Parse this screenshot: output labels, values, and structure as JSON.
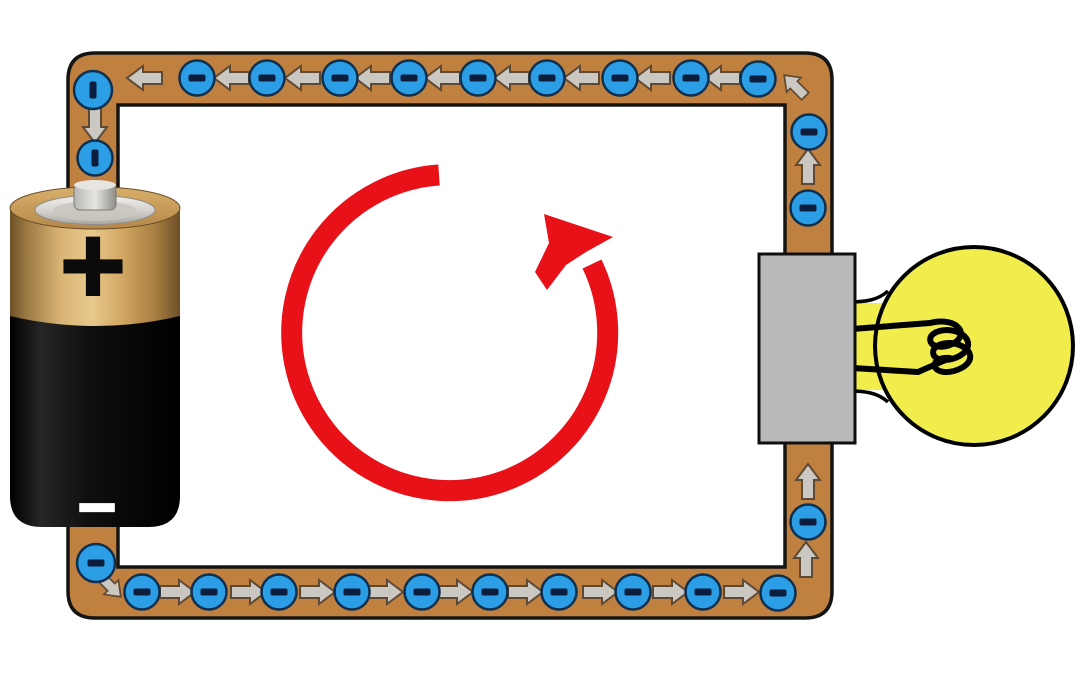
{
  "figure": {
    "type": "circuit-diagram",
    "background": "#ffffff"
  },
  "colors": {
    "wire": "#bf8040",
    "wire_outline": "#141414",
    "electron": "#2b9ee6",
    "electron_outline": "#0e3050",
    "electron_symbol_color": "#0c1d3d",
    "arrow": "#cbc8c1",
    "arrow_outline": "#5e4a34",
    "current_arrow": "#e81118",
    "bulb_glass": "#f0ed4d",
    "bulb_outline": "#000000",
    "bulb_base": "#b9b9b9",
    "battery_gold": "#c89b58",
    "battery_body": "#0a0a0a"
  },
  "battery": {
    "positive_label": "+",
    "negative_label": "−",
    "position": "left"
  },
  "bulb": {
    "position": "right",
    "filament": "coil"
  },
  "current_arrow": {
    "direction": "counterclockwise",
    "color": "#e81118"
  },
  "electron_symbol": "−",
  "particles": {
    "electrons": [
      {
        "x": 93,
        "y": 90,
        "dash": "v",
        "r": 19
      },
      {
        "x": 197,
        "y": 78,
        "dash": "h"
      },
      {
        "x": 267,
        "y": 78,
        "dash": "h"
      },
      {
        "x": 340,
        "y": 78,
        "dash": "h"
      },
      {
        "x": 409,
        "y": 78,
        "dash": "h"
      },
      {
        "x": 478,
        "y": 78,
        "dash": "h"
      },
      {
        "x": 547,
        "y": 78,
        "dash": "h"
      },
      {
        "x": 620,
        "y": 78,
        "dash": "h"
      },
      {
        "x": 691,
        "y": 78,
        "dash": "h"
      },
      {
        "x": 758,
        "y": 79,
        "dash": "h"
      },
      {
        "x": 809,
        "y": 132,
        "dash": "h"
      },
      {
        "x": 808,
        "y": 208,
        "dash": "h"
      },
      {
        "x": 808,
        "y": 522,
        "dash": "h"
      },
      {
        "x": 95,
        "y": 158,
        "dash": "v"
      },
      {
        "x": 96,
        "y": 563,
        "dash": "h",
        "r": 19
      },
      {
        "x": 142,
        "y": 592,
        "dash": "h"
      },
      {
        "x": 209,
        "y": 592,
        "dash": "h"
      },
      {
        "x": 279,
        "y": 592,
        "dash": "h"
      },
      {
        "x": 352,
        "y": 592,
        "dash": "h"
      },
      {
        "x": 422,
        "y": 592,
        "dash": "h"
      },
      {
        "x": 490,
        "y": 592,
        "dash": "h"
      },
      {
        "x": 559,
        "y": 592,
        "dash": "h"
      },
      {
        "x": 633,
        "y": 592,
        "dash": "h"
      },
      {
        "x": 703,
        "y": 592,
        "dash": "h"
      },
      {
        "x": 778,
        "y": 593,
        "dash": "h"
      }
    ],
    "arrows": [
      {
        "x": 145,
        "y": 78,
        "rot": 180
      },
      {
        "x": 232,
        "y": 78,
        "rot": 180
      },
      {
        "x": 303,
        "y": 78,
        "rot": 180
      },
      {
        "x": 373,
        "y": 78,
        "rot": 180
      },
      {
        "x": 443,
        "y": 78,
        "rot": 180
      },
      {
        "x": 512,
        "y": 78,
        "rot": 180
      },
      {
        "x": 582,
        "y": 78,
        "rot": 180
      },
      {
        "x": 653,
        "y": 78,
        "rot": 180
      },
      {
        "x": 723,
        "y": 78,
        "rot": 180
      },
      {
        "x": 795,
        "y": 86,
        "rot": -135,
        "s": 0.85
      },
      {
        "x": 808,
        "y": 167,
        "rot": -90
      },
      {
        "x": 808,
        "y": 482,
        "rot": -90
      },
      {
        "x": 806,
        "y": 560,
        "rot": -90
      },
      {
        "x": 95,
        "y": 125,
        "rot": 90
      },
      {
        "x": 110,
        "y": 586,
        "rot": 45,
        "s": 0.85
      },
      {
        "x": 177,
        "y": 592,
        "rot": 0
      },
      {
        "x": 248,
        "y": 592,
        "rot": 0
      },
      {
        "x": 317,
        "y": 592,
        "rot": 0
      },
      {
        "x": 385,
        "y": 592,
        "rot": 0
      },
      {
        "x": 455,
        "y": 592,
        "rot": 0
      },
      {
        "x": 525,
        "y": 592,
        "rot": 0
      },
      {
        "x": 600,
        "y": 592,
        "rot": 0
      },
      {
        "x": 670,
        "y": 592,
        "rot": 0
      },
      {
        "x": 741,
        "y": 592,
        "rot": 0
      }
    ]
  }
}
